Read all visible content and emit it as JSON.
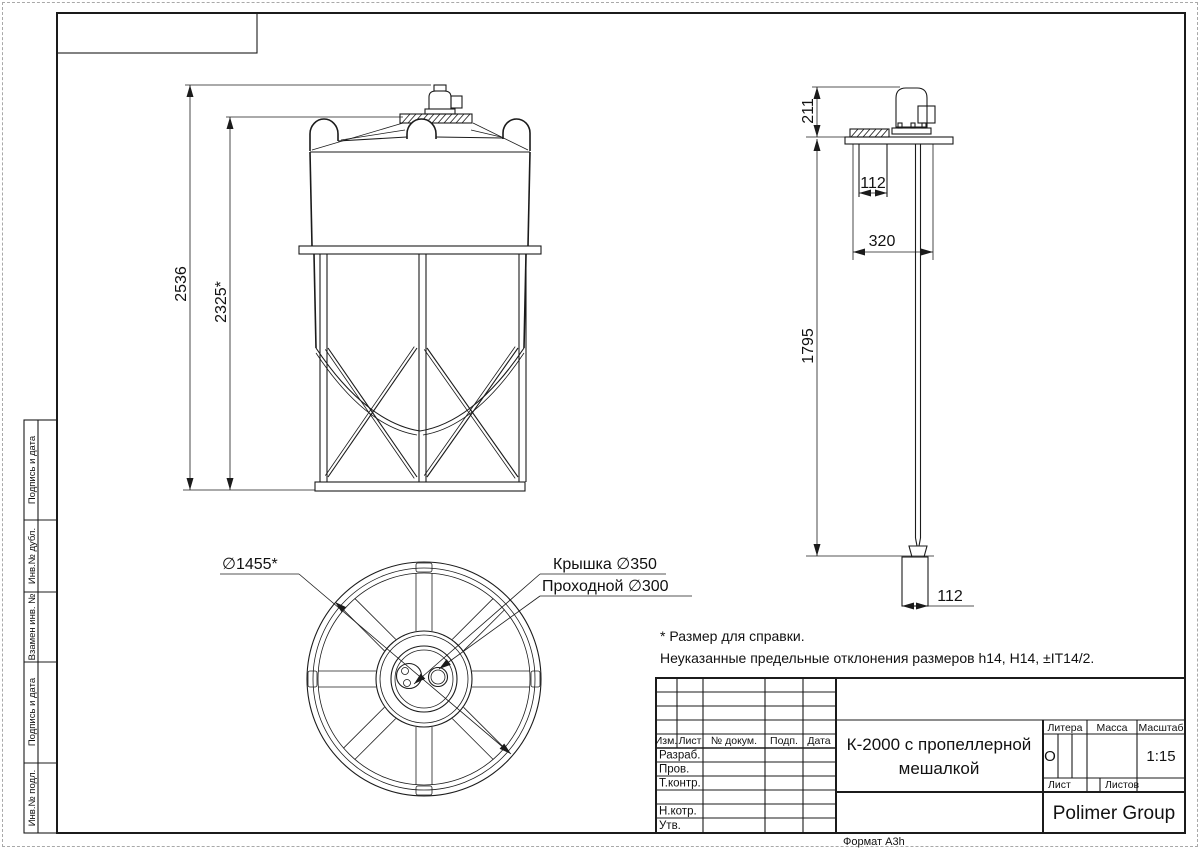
{
  "page": {
    "format_label": "Формат А3h"
  },
  "stamps": [
    "Подпись и дата",
    "Инв.№ дубл.",
    "Взамен инв. №",
    "Подпись и дата",
    "Инв.№ подл."
  ],
  "front_view": {
    "dim_total": "2536",
    "dim_tank": "2325*"
  },
  "side_view": {
    "dim_motor": "211",
    "dim_neck": "112",
    "dim_plate": "320",
    "dim_shaft": "1795",
    "dim_prop": "112"
  },
  "top_view": {
    "dim_diameter": "∅1455*",
    "label_cover": "Крышка ∅350",
    "label_port": "Проходной ∅300"
  },
  "notes": {
    "line1": "* Размер для справки.",
    "line2": "Неуказанные предельные отклонения размеров h14, H14, ±IT14/2."
  },
  "title_block": {
    "col_izm": "Изм.",
    "col_list": "Лист",
    "col_doc": "№ докум.",
    "col_podp": "Подп.",
    "col_data": "Дата",
    "row_razrab": "Разраб.",
    "row_prov": "Пров.",
    "row_tkontr": "Т.контр.",
    "row_nkontr": "Н.котр.",
    "row_utv": "Утв.",
    "title_line1": "К-2000 с пропеллерной",
    "title_line2": "мешалкой",
    "litera_label": "Литера",
    "massa_label": "Масса",
    "masshtab_label": "Масштаб",
    "litera_value": "О",
    "scale_value": "1:15",
    "list_label": "Лист",
    "listov_label": "Листов",
    "company": "Polimer Group"
  }
}
